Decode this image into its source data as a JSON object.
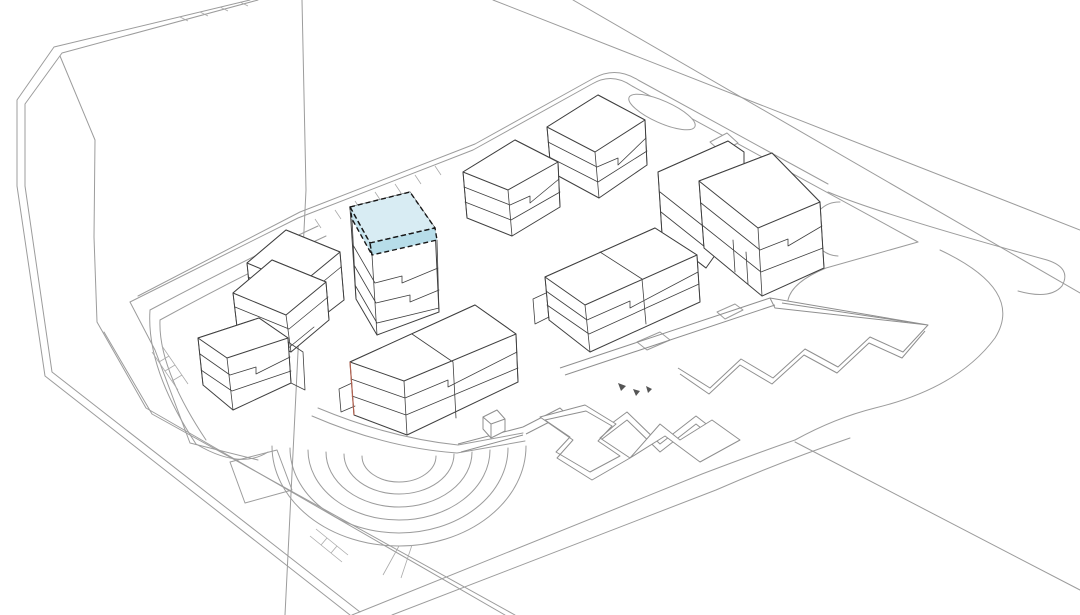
{
  "document": {
    "kind": "axonometric-site-plan-drawing",
    "background": "#ffffff"
  },
  "colors": {
    "highlight_top": "#d8ecf3",
    "highlight_side_left": "#c6e4ee",
    "highlight_side_front": "#b7dde9",
    "highlight_outline": "#161616",
    "building_line": "#404040",
    "landscape_line": "#9c9c9c",
    "accent_edge": "#b2614f"
  },
  "buildings": [
    {
      "id": "north-tower-rear",
      "highlighted": false
    },
    {
      "id": "north-tower-front",
      "highlighted": false
    },
    {
      "id": "highlighted-tower",
      "highlighted": true
    },
    {
      "id": "east-building",
      "highlighted": false
    },
    {
      "id": "central-twin-building",
      "highlighted": false
    },
    {
      "id": "south-building",
      "highlighted": false
    },
    {
      "id": "northwest-stepped-tower",
      "highlighted": false
    },
    {
      "id": "west-building",
      "highlighted": false
    }
  ],
  "site_features": [
    "perimeter-roads",
    "site-plateau",
    "landscape-berms",
    "amphitheater-steps",
    "zigzag-walkways",
    "stair-flights",
    "running-track-oval"
  ]
}
